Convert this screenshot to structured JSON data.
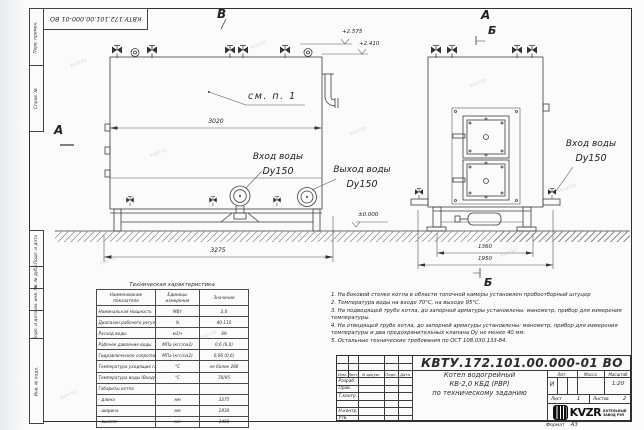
{
  "colors": {
    "line": "#3c3c3c",
    "paper": "#fbfbfb",
    "watermark": "#a9b8ca"
  },
  "watermark": "kvzr.kz",
  "stamps": {
    "top_doc_number": "КВТУ.172.101.00.000-01 ВО",
    "margin": [
      "Перв. примен.",
      "Справ. №",
      "Подп. и дата",
      "Инв. № дубл.",
      "Взам. инв. №",
      "Подп. и дата",
      "Инв. № подл."
    ]
  },
  "views": {
    "labels": {
      "v_top": "В",
      "a_left": "А",
      "a_right": "А",
      "b_right_top": "Б",
      "b_right_bottom": "Б"
    },
    "see_note": "см. п. 1",
    "dimensions": {
      "left_width": "3020",
      "left_overall": "3275",
      "right_inner": "1360",
      "right_overall": "1950"
    },
    "elevations": {
      "top1": "+2.575",
      "top2": "+2.410",
      "ground": "±0.000"
    },
    "ports": {
      "inlet_left": {
        "line1": "Вход воды",
        "line2": "Dy150"
      },
      "outlet_left": {
        "line1": "Выход воды",
        "line2": "Dy150"
      },
      "inlet_right": {
        "line1": "Вход воды",
        "line2": "Dy150"
      }
    }
  },
  "tech_table": {
    "title": "Техническая характеристика",
    "headers": [
      "Наименование показателя",
      "Единицы измерения",
      "Значение"
    ],
    "rows": [
      [
        "Номинальная мощность",
        "МВт",
        "2,0"
      ],
      [
        "Диапазон рабочего регулирования",
        "%",
        "40-110"
      ],
      [
        "Расход воды",
        "м3/ч",
        "69"
      ],
      [
        "Рабочее давление воды",
        "МПа (кгс/см2)",
        "0,6 (6,0)"
      ],
      [
        "Гидравлическое сопротивление котла",
        "МПа (кгс/см2)",
        "0,06 (0,6)"
      ],
      [
        "Температура уходящих газов",
        "°С",
        "не более 280"
      ],
      [
        "Температура воды (Вход/Выход)",
        "°С",
        "70/95"
      ],
      [
        "Габариты котла",
        "",
        ""
      ],
      [
        "- длина",
        "мм",
        "3275"
      ],
      [
        "- ширина",
        "мм",
        "1830"
      ],
      [
        "- высота",
        "мм",
        "2460"
      ]
    ]
  },
  "notes": [
    "1.  На боковой стенке котла в области топочной камеры установлен пробоотборный штуцер",
    "2.  Температура воды на входе 70°С, на выходе 95°С.",
    "3.  На подводящей трубе котла, до запорной арматуры установлены: манометр, прибор для измерения температуры.",
    "4.  На отводящей трубе котла, до запорной арматуры установлены: манометр, прибор для измерения температуры и два предохранительных клапана Dу не менее 40 мм.",
    "5.  Остальные технические требования по ОСТ 108.030.133-84."
  ],
  "title_block": {
    "doc_number": "КВТУ.172.101.00.000-01 ВО",
    "product": {
      "line1": "Котел водогрейный",
      "line2": "КВ-2,0 КБД (РВР)",
      "line3": "по техническому заданию"
    },
    "columns": [
      "Изм.",
      "Лист",
      "N докум.",
      "Подп.",
      "Дата"
    ],
    "rows": [
      "Разраб.",
      "Пров.",
      "Т.контр.",
      "",
      "Н.контр.",
      "Утв."
    ],
    "right": {
      "lit_label": "Лит.",
      "lit_value": "И",
      "mass_label": "Масса",
      "scale_label": "Масштаб",
      "scale_value": "1:20",
      "sheet_label": "Лист",
      "sheet_value": "1",
      "sheets_label": "Листов",
      "sheets_value": "2"
    },
    "logo": {
      "text": "KVZR",
      "sub1": "КОТЕЛЬНЫЙ",
      "sub2": "ЗАВОД РЭП"
    },
    "format_label": "Формат",
    "format_value": "А3"
  }
}
